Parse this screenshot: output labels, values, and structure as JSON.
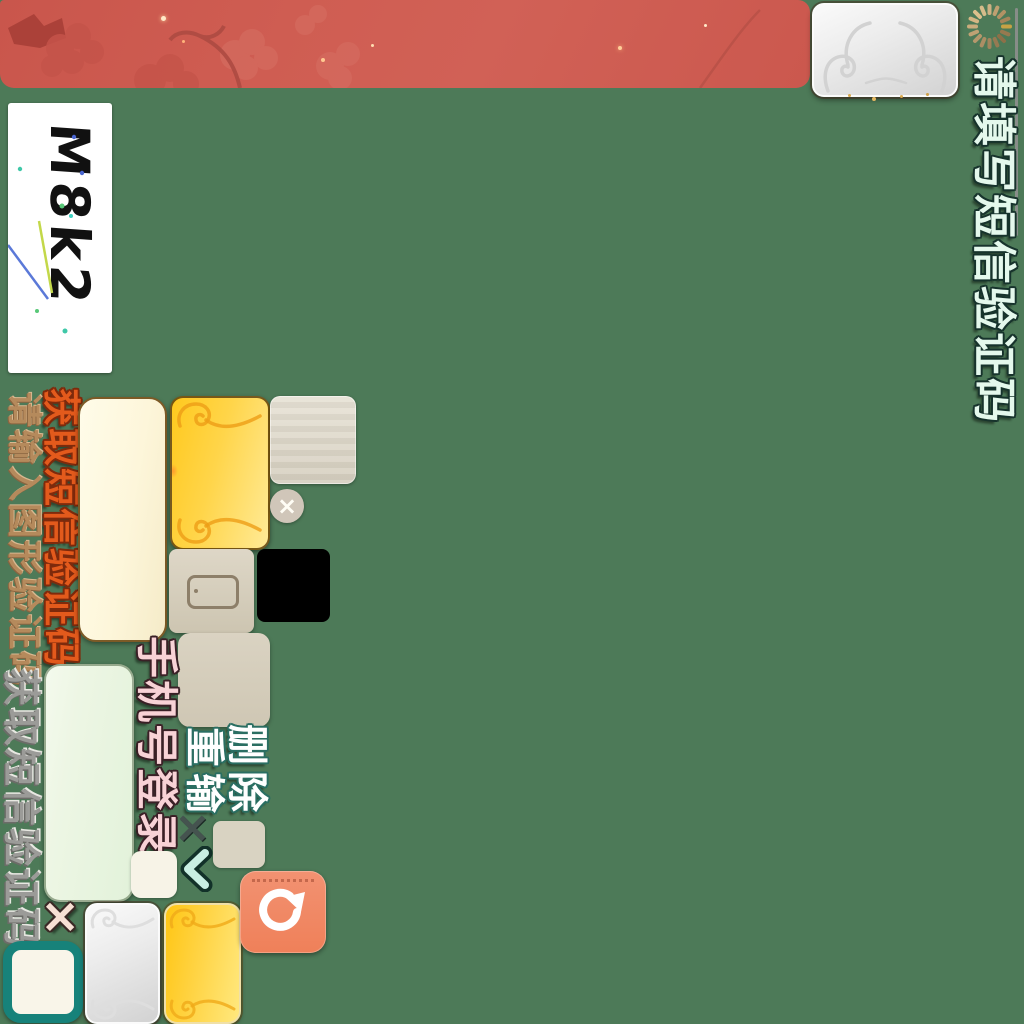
{
  "colors": {
    "background": "#4d7a58",
    "banner_red": "#cd5a50",
    "gold": "#ffd54a",
    "silver": "#e6e6e6",
    "teal_accent": "#17827a",
    "coral_accent": "#f08a64"
  },
  "header": {
    "banner_decoration": "plum-blossom-pattern",
    "ornate_button_icon": "cloud-scroll-ornament",
    "spinner_icon": "loading-spinner",
    "prompt_vertical": "请填写短信验证码"
  },
  "captcha": {
    "image_code": "M8k2"
  },
  "links": {
    "get_sms_code_orange": "获取短信验证码",
    "enter_graphic_code": "请输入图形验证码",
    "get_sms_code_gray": "获取短信验证码"
  },
  "login": {
    "phone_login_vertical": "手机号登录"
  },
  "captcha_actions": {
    "delete_label": "删除",
    "retype_label": "重输",
    "dark_x": "×",
    "pale_x": "×",
    "circle_close_x": "×",
    "back_chevron_icon": "chevron-left"
  },
  "icons": {
    "refresh": "refresh-circular-arrow",
    "phone": "smartphone-outline",
    "spinner": "loading-spinner",
    "cloud": "cloud-scroll-ornament"
  }
}
